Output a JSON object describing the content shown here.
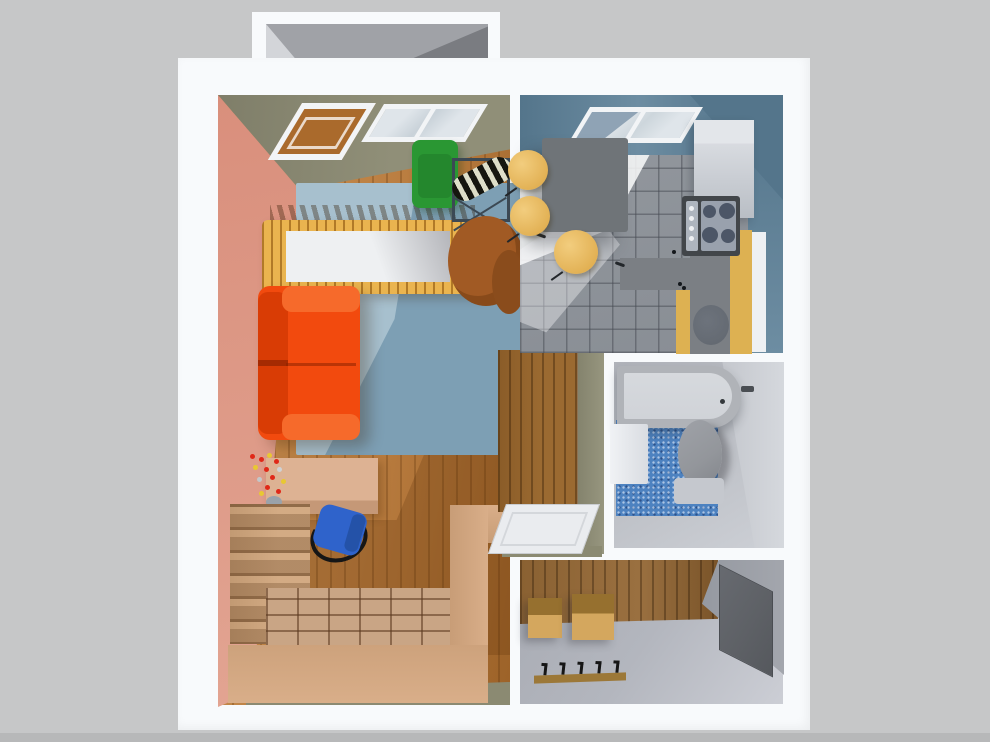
{
  "meta": {
    "type": "3d-rendered floor plan, top-down view",
    "description": "One-bedroom apartment 3D plan with living room, kitchen, bathroom, entry hall, balcony and study nook"
  },
  "palette": {
    "bg": "#c6c7c8",
    "bg-bottom": "#b7b8b9",
    "wall-white": "#f8fafc",
    "balcony-floor": "#a0a2a7",
    "balcony-light": "#d3d5d9",
    "balcony-dark": "#7a7c81",
    "pink-wall": "#d98f7c",
    "pink-wall-2": "#e2a492",
    "olive-wall": "#908f78",
    "olive-wall-2": "#7f7e69",
    "olive-strip": "#8b8a72",
    "wood": "#b97c3f",
    "wood-2": "#cb9254",
    "wood-3": "#9c6228",
    "wood-shadow": "rgba(80,42,6,0.25)",
    "rug": "#a7c0ce",
    "rug-shadow": "#7d9fb4",
    "sofa": "#f24a0e",
    "sofa-2": "#d93c05",
    "sofa-3": "#f66a2b",
    "crib": "#eab44f",
    "mattress": "#eef0f2",
    "green-chair": "#2a9733",
    "green-chair-2": "#1f7a28",
    "zebra-dark": "#16160f",
    "zebra-light": "#dedec8",
    "wire-frame": "#3c4954",
    "brown-chair": "#a15a24",
    "brown-chair-2": "#8a4c1c",
    "desk": "#ddb293",
    "desk-2": "#c59877",
    "nook-wall": "#d9ae89",
    "nook-floor": "#c9a585",
    "nook-grout": "rgba(90,55,30,0.55)",
    "shelf": "#d3ab84",
    "chair-blue": "#2f63cb",
    "chair-blue-2": "#2452a8",
    "ink": "#161616",
    "flower-red": "#e02818",
    "flower-yellow": "#e8c832",
    "wardrobe": "#9b6a31",
    "door-white": "#eaecef",
    "frame-white": "#f2f4f6",
    "glass": "#dfe5ea",
    "pane-open": "#8fa3b5",
    "kwall": "#6d8da2",
    "kwall-2": "#54758b",
    "kfloor": "#94999f",
    "kfloor-2": "#888d94",
    "grout": "rgba(70,74,82,0.5)",
    "sun": "rgba(250,251,252,0.85)",
    "ktable": "#6f7478",
    "chair-yellow": "#ecbf63",
    "chair-yellow-2": "#dca644",
    "fridge": "#d8dbe0",
    "fridge-2": "#b9bec5",
    "stove": "#42464a",
    "stove-panel": "#aeb5be",
    "burners": "#99a1ad",
    "burner": "#4c5667",
    "counter-gray": "#7b7f84",
    "counter-yellow": "#ddb152",
    "sink": "#61676f",
    "bfloor": "#c0c3c9",
    "bwall": "#d5d8dd",
    "tub": "#b0b3b8",
    "tub-2": "#d0d3d8",
    "mosaic": "#4d82c0",
    "toilet": "#93969b",
    "toilet-2": "#c5c8ce",
    "bsink": "#f0f2f5",
    "efloor": "#b3b6be",
    "ewood": "#8a6132",
    "box": "#d4a75e",
    "box-2": "#96702f",
    "rack": "#9c7838",
    "mirror": "#5e6166",
    "ewall": "#a3a6ad"
  },
  "scene": {
    "rooms": [
      {
        "name": "balcony",
        "furniture": []
      },
      {
        "name": "living-room",
        "furniture": [
          "balcony-door",
          "window",
          "area-rug",
          "crib",
          "orange-sofa",
          "green-armchair",
          "wire-side-table",
          "striped-cushion",
          "brown-armchair",
          "wardrobe",
          "open-door"
        ]
      },
      {
        "name": "study-nook",
        "furniture": [
          "desk",
          "flower-bouquet",
          "office-chair",
          "shelving-unit"
        ]
      },
      {
        "name": "kitchen",
        "furniture": [
          "window",
          "refrigerator",
          "stove",
          "counter",
          "sink",
          "dining-table",
          "three-yellow-chairs"
        ]
      },
      {
        "name": "bathroom",
        "furniture": [
          "bathtub",
          "wash-basin",
          "toilet",
          "mosaic-floor-mat"
        ]
      },
      {
        "name": "entry-hall",
        "furniture": [
          "storage-box",
          "storage-box",
          "coat-rack",
          "mirror"
        ]
      }
    ]
  }
}
